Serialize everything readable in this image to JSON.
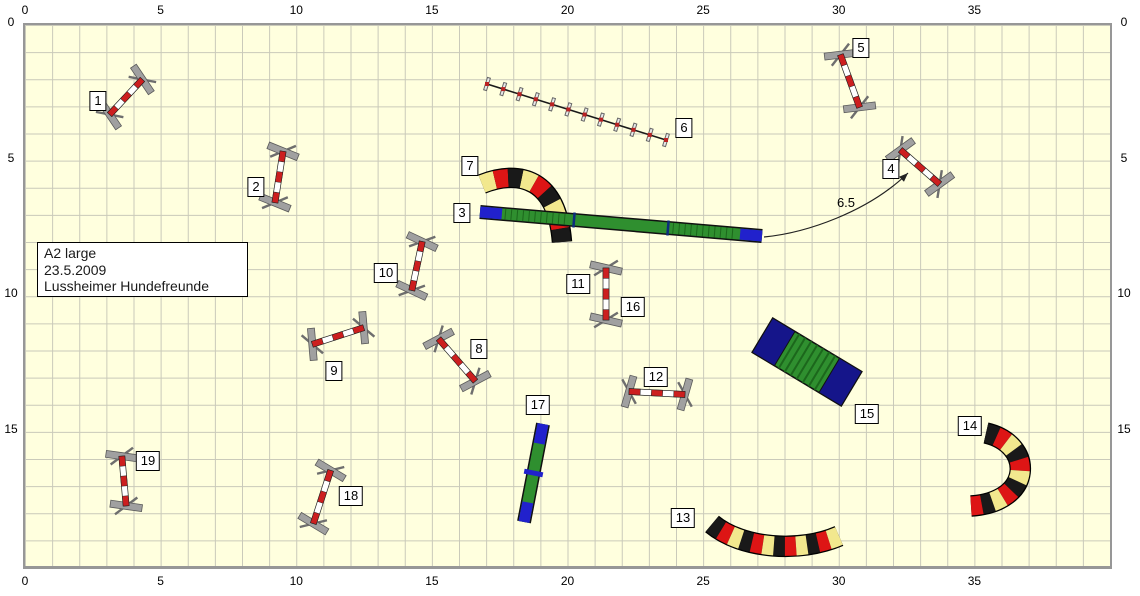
{
  "info_box": {
    "line1": "A2 large",
    "line2": "23.5.2009",
    "line3": "Lussheimer Hundefreunde"
  },
  "field": {
    "origin_x": 25,
    "origin_y": 25,
    "px_per_m": 27.125,
    "width_m": 40,
    "height_m": 20,
    "background": "#ffffde",
    "grid_color": "#c9c9b9",
    "border_color": "#979797",
    "x_ticks": [
      0,
      5,
      10,
      15,
      20,
      25,
      30,
      35
    ],
    "y_ticks": [
      0,
      5,
      10,
      15
    ]
  },
  "annotation": {
    "label": "6.5",
    "path": "M 764 237 C 806 233, 868 212, 908 173",
    "label_x": 846,
    "label_y": 207,
    "arrow_x": 908,
    "arrow_y": 173,
    "arrow_angle": -44
  },
  "colors": {
    "jump_red": "#cc1f1f",
    "jump_white": "#ffffff",
    "wing_gray": "#a0a0a0",
    "wing_dark": "#6e6e6e",
    "tunnel_black": "#191919",
    "tunnel_red": "#dd1515",
    "tunnel_yellow": "#f2e88e",
    "plank_green": "#2f8f2f",
    "contact_blue": "#2121cc",
    "aframe_navy": "#15158a",
    "rung_green": "#1c671c",
    "outline": "#111111"
  },
  "obstacles": [
    {
      "number": "1",
      "type": "jump",
      "x": 126,
      "y": 97,
      "angle": -47,
      "len": 48,
      "label_x": 98,
      "label_y": 101
    },
    {
      "number": "2",
      "type": "jump",
      "x": 279,
      "y": 177,
      "angle": 99,
      "len": 52,
      "label_x": 256,
      "label_y": 187
    },
    {
      "number": "3",
      "type": "dogwalk",
      "x1": 480,
      "y1": 212,
      "x2": 762,
      "y2": 236,
      "width": 11,
      "label_x": 462,
      "label_y": 213
    },
    {
      "number": "4",
      "type": "jump",
      "x": 920,
      "y": 167,
      "angle": 41,
      "len": 52,
      "label_x": 891,
      "label_y": 169
    },
    {
      "number": "5",
      "type": "jump",
      "x": 850,
      "y": 81,
      "angle": 70,
      "len": 56,
      "label_x": 861,
      "label_y": 48
    },
    {
      "number": "6",
      "type": "weave",
      "x1": 487,
      "y1": 84,
      "x2": 666,
      "y2": 140,
      "poles": 12,
      "label_x": 684,
      "label_y": 128
    },
    {
      "number": "7",
      "type": "tunnel",
      "path": "M 482 184 C 520 169, 557 179, 562 242",
      "width": 18,
      "segments": 9,
      "first": "yellow",
      "label_x": 470,
      "label_y": 166
    },
    {
      "number": "8",
      "type": "jump",
      "x": 457,
      "y": 360,
      "angle": 49,
      "len": 56,
      "label_x": 479,
      "label_y": 349
    },
    {
      "number": "9",
      "type": "jump",
      "x": 338,
      "y": 336,
      "angle": -18,
      "len": 54,
      "label_x": 334,
      "label_y": 371
    },
    {
      "number": "10",
      "type": "jump",
      "x": 417,
      "y": 266,
      "angle": -78,
      "len": 50,
      "label_x": 386,
      "label_y": 273
    },
    {
      "number": "11",
      "type": "jump",
      "x": 606,
      "y": 294,
      "angle": 90,
      "len": 52,
      "label_x": 578,
      "label_y": 284
    },
    {
      "number": "12",
      "type": "jump",
      "x": 657,
      "y": 393,
      "angle": 3,
      "len": 56,
      "label_x": 656,
      "label_y": 377
    },
    {
      "number": "13",
      "type": "tunnel",
      "path": "M 712 524 C 742 549, 800 553, 839 536",
      "width": 19,
      "segments": 12,
      "first": "black",
      "label_x": 683,
      "label_y": 518
    },
    {
      "number": "14",
      "type": "tunnel",
      "path": "M 986 433 C 1034 444, 1034 502, 971 506",
      "width": 19,
      "segments": 11,
      "first": "black",
      "label_x": 970,
      "label_y": 426
    },
    {
      "number": "15",
      "type": "aframe",
      "x": 807,
      "y": 362,
      "angle": 31,
      "len": 104,
      "width": 40,
      "label_x": 867,
      "label_y": 414
    },
    {
      "number": "16",
      "type": "ref",
      "label_x": 633,
      "label_y": 307
    },
    {
      "number": "17",
      "type": "seesaw",
      "x1": 543,
      "y1": 424,
      "x2": 524,
      "y2": 522,
      "width": 11,
      "label_x": 538,
      "label_y": 405
    },
    {
      "number": "18",
      "type": "jump",
      "x": 322,
      "y": 497,
      "angle": 108,
      "len": 56,
      "label_x": 351,
      "label_y": 496
    },
    {
      "number": "19",
      "type": "jump",
      "x": 124,
      "y": 481,
      "angle": 85,
      "len": 50,
      "label_x": 148,
      "label_y": 461
    }
  ]
}
